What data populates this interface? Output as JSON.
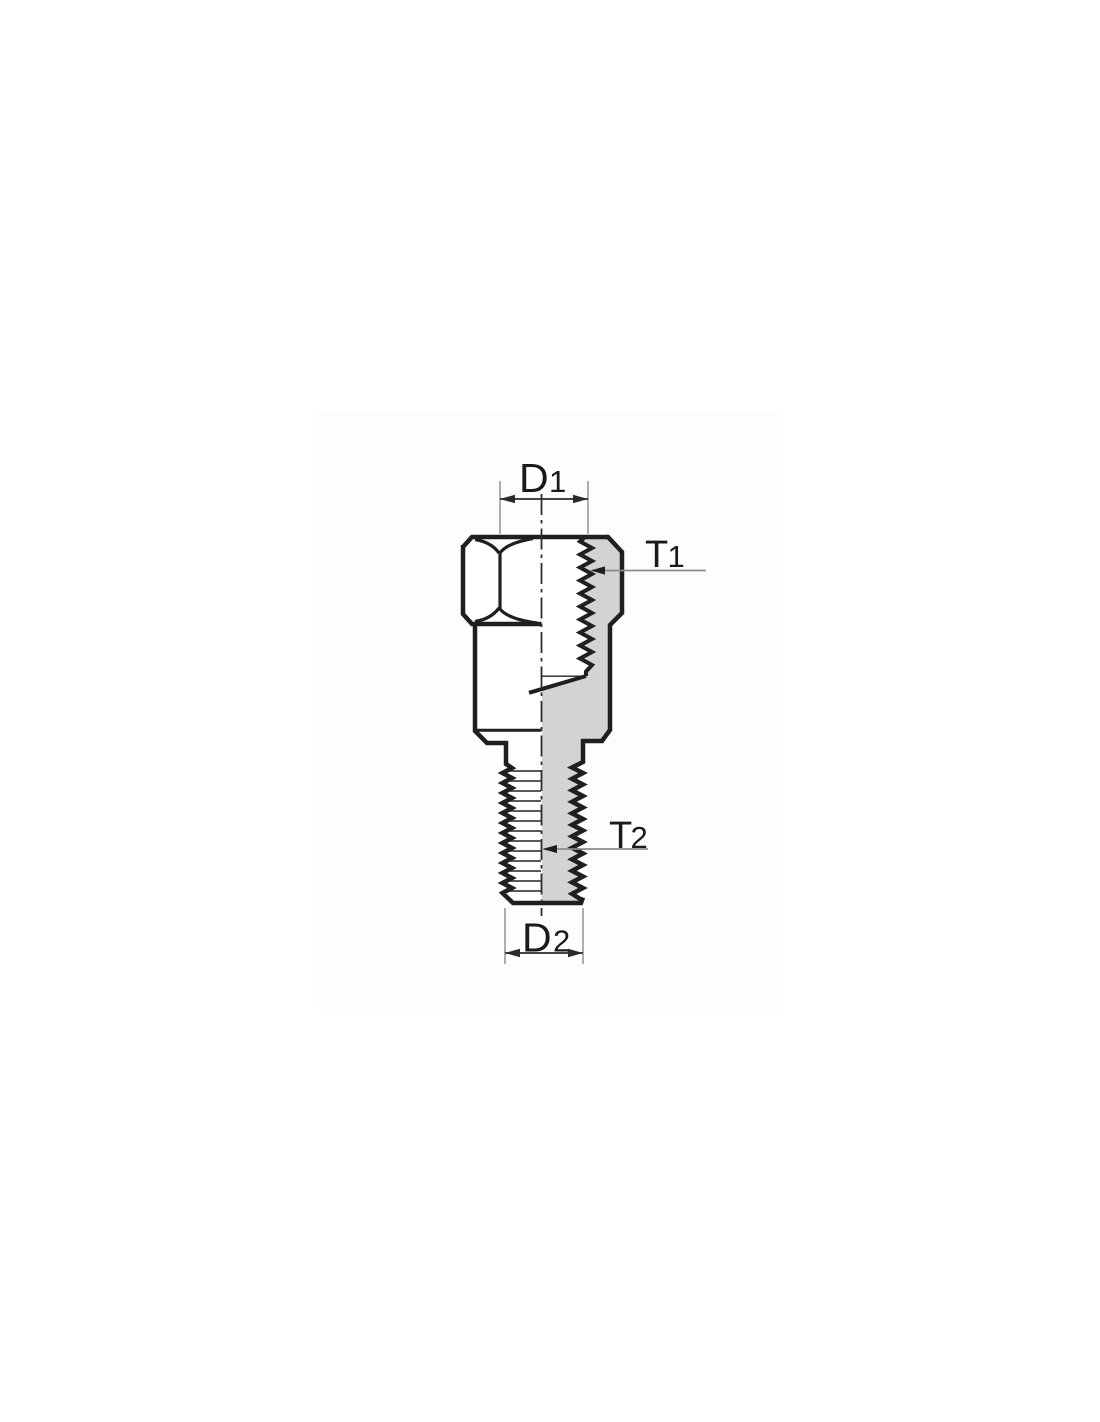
{
  "page": {
    "background": "#ffffff",
    "image_area_tint": "#fdfdfd"
  },
  "drawing": {
    "type": "technical-drawing",
    "subject": "threaded mirror adapter, half section view with internal thread (top) and external stud thread (bottom)",
    "colors": {
      "outline": "#1f1f1f",
      "section_fill": "#d3d3d3",
      "detail_line": "#222222",
      "centerline": "#2e2e2e",
      "dimension": "#2a2a2a",
      "extension_line": "#9a9a9a",
      "leader_line": "#8c8c8c",
      "text": "#1a1a1a"
    },
    "labels": {
      "d1": {
        "letter": "D",
        "sub": "1"
      },
      "t1": {
        "letter": "T",
        "sub": "1"
      },
      "t2": {
        "letter": "T",
        "sub": "2"
      },
      "d2": {
        "letter": "D",
        "sub": "2"
      }
    }
  }
}
